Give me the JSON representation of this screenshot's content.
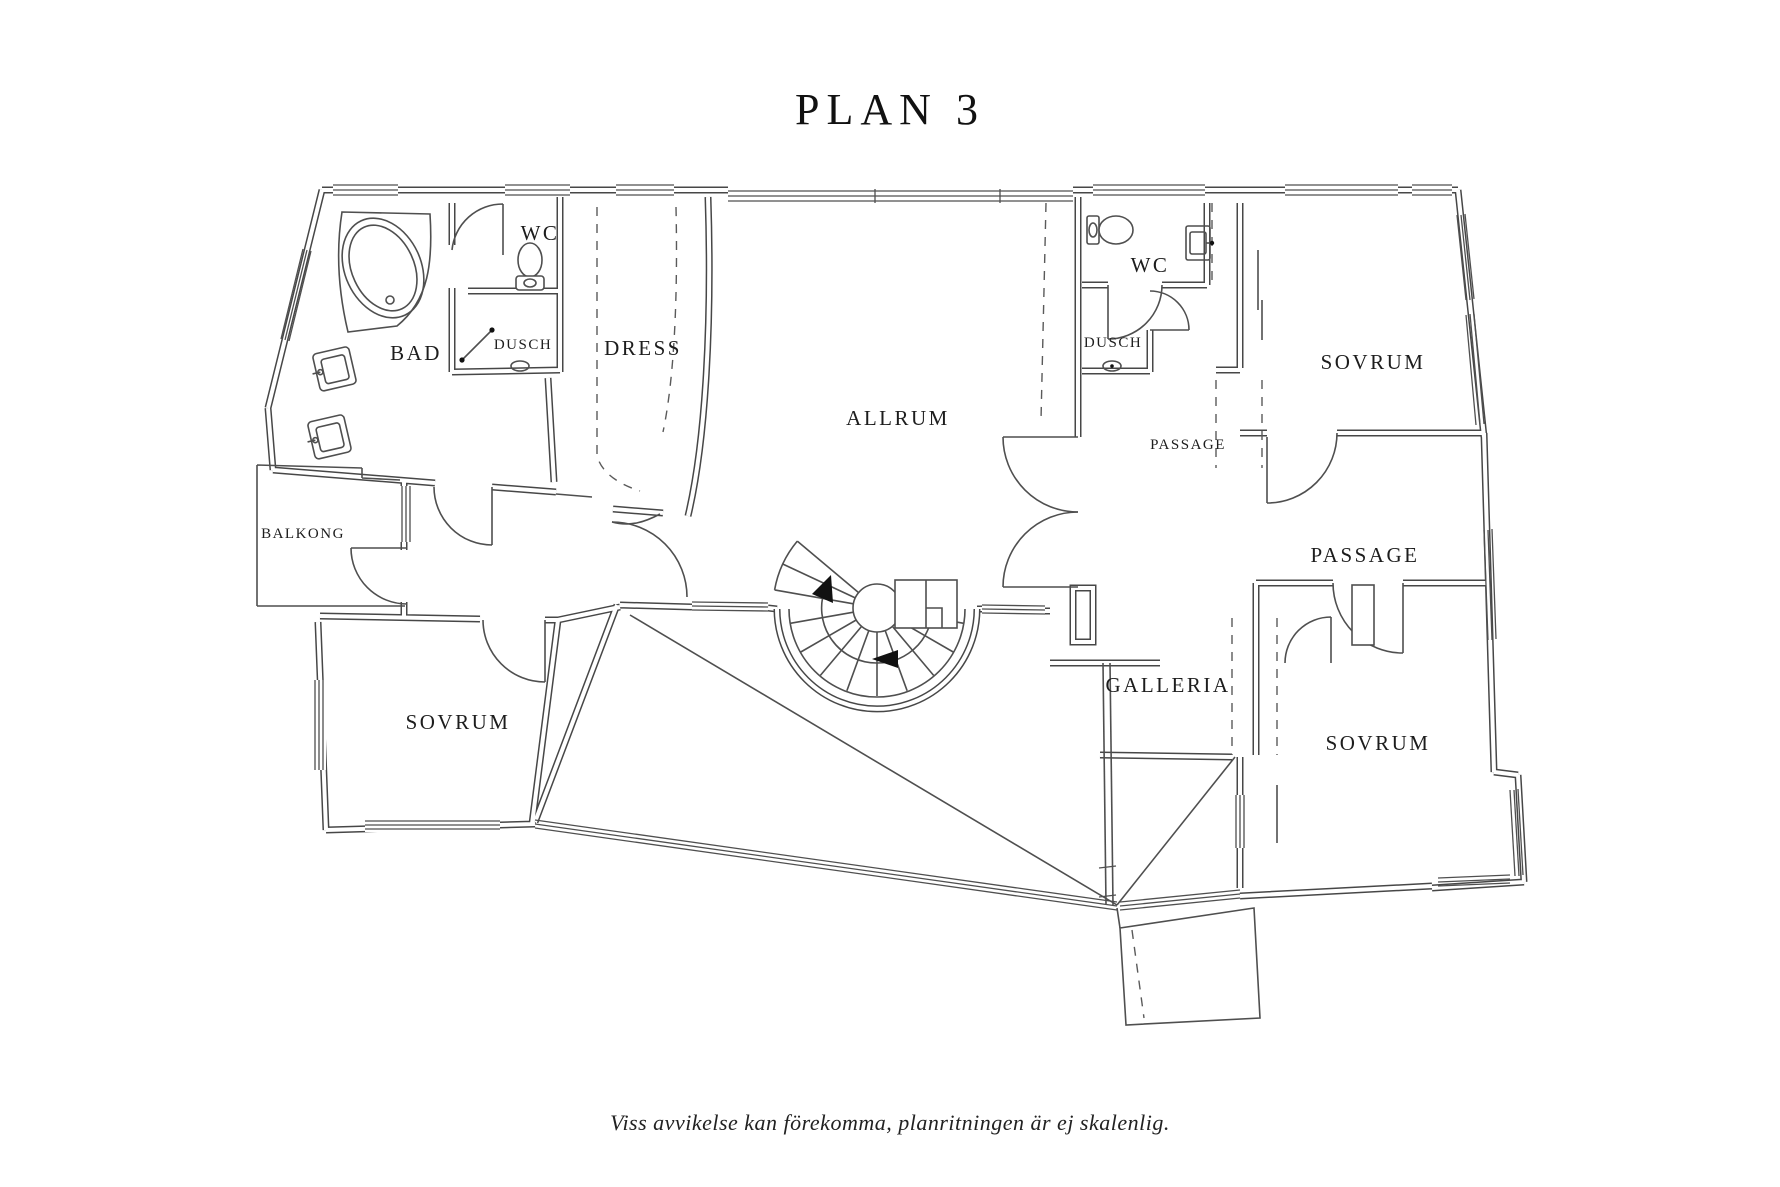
{
  "title": "PLAN 3",
  "disclaimer": "Viss avvikelse kan förekomma, planritningen är ej skalenlig.",
  "colors": {
    "line": "#474747",
    "text": "#1d1d1d",
    "background": "#ffffff"
  },
  "floor": {
    "rooms": [
      {
        "id": "bad",
        "label": "BAD"
      },
      {
        "id": "wc-left",
        "label": "WC"
      },
      {
        "id": "dusch-left",
        "label": "DUSCH"
      },
      {
        "id": "dress",
        "label": "DRESS"
      },
      {
        "id": "allrum",
        "label": "ALLRUM"
      },
      {
        "id": "wc-right",
        "label": "WC"
      },
      {
        "id": "dusch-right",
        "label": "DUSCH"
      },
      {
        "id": "passage-small",
        "label": "PASSAGE"
      },
      {
        "id": "sovrum-top-right",
        "label": "SOVRUM"
      },
      {
        "id": "passage",
        "label": "PASSAGE"
      },
      {
        "id": "balkong",
        "label": "BALKONG"
      },
      {
        "id": "sovrum-bottom-left",
        "label": "SOVRUM"
      },
      {
        "id": "galleria",
        "label": "GALLERIA"
      },
      {
        "id": "sovrum-bottom-right",
        "label": "SOVRUM"
      }
    ]
  }
}
